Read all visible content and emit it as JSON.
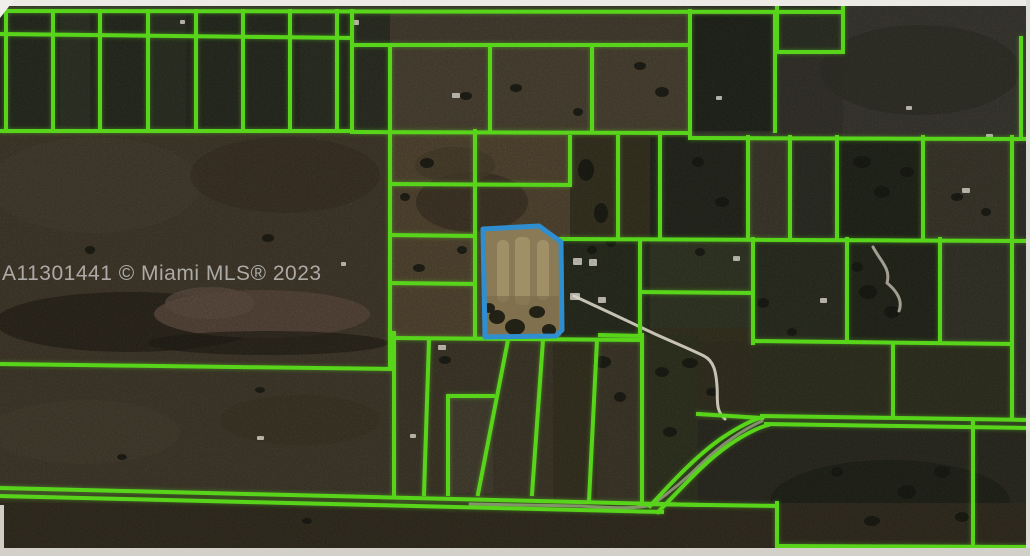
{
  "map": {
    "watermark": "A11301441 © Miami MLS® 2023",
    "colors": {
      "parcel_line": "#58d51b",
      "subject_parcel_line": "#2f8ecf",
      "subject_parcel_fill": "#8a7a55",
      "road": "#d8d3c5",
      "watermark_text": "#b6b5b1",
      "terrain_base": "#37321f"
    },
    "viewport": {
      "width": 1030,
      "height": 556
    },
    "terrain": [
      {
        "t": "rect",
        "x": 0,
        "y": 0,
        "width": 1030,
        "height": 556,
        "fill": "#37321f"
      },
      {
        "t": "rect",
        "x": 0,
        "y": 0,
        "width": 1030,
        "height": 11,
        "fill": "#3b372c"
      },
      {
        "t": "ellipse",
        "cx": 150,
        "cy": 70,
        "rx": 80,
        "ry": 40,
        "fill": "#20231a",
        "opacity": 0.5
      },
      {
        "t": "ellipse",
        "cx": 520,
        "cy": 55,
        "rx": 120,
        "ry": 40,
        "fill": "#403a2c",
        "opacity": 0.5
      },
      {
        "t": "rect",
        "x": 0,
        "y": 10,
        "width": 352,
        "height": 121,
        "fill": "#262a1e"
      },
      {
        "t": "rect",
        "x": 60,
        "y": 14,
        "width": 30,
        "height": 115,
        "fill": "#353b2b",
        "opacity": 0.5
      },
      {
        "t": "rect",
        "x": 152,
        "y": 14,
        "width": 34,
        "height": 115,
        "fill": "#323828",
        "opacity": 0.45
      },
      {
        "t": "rect",
        "x": 300,
        "y": 14,
        "width": 36,
        "height": 115,
        "fill": "#2d3224",
        "opacity": 0.5
      },
      {
        "t": "rect",
        "x": 352,
        "y": 10,
        "width": 38,
        "height": 121,
        "fill": "#2b2e22"
      },
      {
        "t": "rect",
        "x": 390,
        "y": 10,
        "width": 300,
        "height": 35,
        "fill": "#463e30"
      },
      {
        "t": "rect",
        "x": 390,
        "y": 45,
        "width": 300,
        "height": 86,
        "fill": "#4d4433"
      },
      {
        "t": "rect",
        "x": 690,
        "y": 0,
        "width": 340,
        "height": 138,
        "fill": "#34322a"
      },
      {
        "t": "rect",
        "x": 692,
        "y": 15,
        "width": 83,
        "height": 116,
        "fill": "#20241a"
      },
      {
        "t": "rect",
        "x": 777,
        "y": 0,
        "width": 66,
        "height": 52,
        "fill": "#2c3024"
      },
      {
        "t": "rect",
        "x": 843,
        "y": 0,
        "width": 187,
        "height": 138,
        "fill": "#3a3830"
      },
      {
        "t": "ellipse",
        "cx": 920,
        "cy": 70,
        "rx": 100,
        "ry": 45,
        "fill": "#302e26",
        "opacity": 0.8
      },
      {
        "t": "rect",
        "x": 0,
        "y": 131,
        "width": 390,
        "height": 234,
        "fill": "#42392a"
      },
      {
        "t": "ellipse",
        "cx": 95,
        "cy": 185,
        "rx": 105,
        "ry": 48,
        "fill": "#4b4132",
        "opacity": 0.55
      },
      {
        "t": "ellipse",
        "cx": 285,
        "cy": 175,
        "rx": 95,
        "ry": 38,
        "fill": "#392f22",
        "opacity": 0.6
      },
      {
        "t": "ellipse",
        "cx": 130,
        "cy": 322,
        "rx": 135,
        "ry": 30,
        "fill": "#241f15",
        "opacity": 0.75
      },
      {
        "t": "ellipse",
        "cx": 262,
        "cy": 314,
        "rx": 108,
        "ry": 24,
        "fill": "#5a483a"
      },
      {
        "t": "ellipse",
        "cx": 210,
        "cy": 303,
        "rx": 45,
        "ry": 16,
        "fill": "#635044",
        "opacity": 0.8
      },
      {
        "t": "ellipse",
        "cx": 268,
        "cy": 343,
        "rx": 120,
        "ry": 12,
        "fill": "#1d1a12",
        "opacity": 0.65
      },
      {
        "t": "rect",
        "x": 390,
        "y": 131,
        "width": 180,
        "height": 209,
        "fill": "#564831"
      },
      {
        "t": "ellipse",
        "cx": 472,
        "cy": 202,
        "rx": 56,
        "ry": 30,
        "fill": "#3d3325",
        "opacity": 0.85
      },
      {
        "t": "ellipse",
        "cx": 455,
        "cy": 165,
        "rx": 40,
        "ry": 18,
        "fill": "#4a3e2c",
        "opacity": 0.8
      },
      {
        "t": "rect",
        "x": 561,
        "y": 238,
        "width": 89,
        "height": 100,
        "fill": "#272b1c"
      },
      {
        "t": "rect",
        "x": 650,
        "y": 137,
        "width": 98,
        "height": 102,
        "fill": "#23261c"
      },
      {
        "t": "rect",
        "x": 748,
        "y": 137,
        "width": 42,
        "height": 102,
        "fill": "#3e392d"
      },
      {
        "t": "rect",
        "x": 790,
        "y": 137,
        "width": 47,
        "height": 102,
        "fill": "#2b2d23"
      },
      {
        "t": "rect",
        "x": 837,
        "y": 137,
        "width": 86,
        "height": 102,
        "fill": "#202418"
      },
      {
        "t": "rect",
        "x": 923,
        "y": 137,
        "width": 89,
        "height": 102,
        "fill": "#3b372b"
      },
      {
        "t": "rect",
        "x": 1012,
        "y": 137,
        "width": 18,
        "height": 281,
        "fill": "#31302a"
      },
      {
        "t": "rect",
        "x": 650,
        "y": 240,
        "width": 103,
        "height": 88,
        "fill": "#323723"
      },
      {
        "t": "rect",
        "x": 753,
        "y": 240,
        "width": 94,
        "height": 101,
        "fill": "#2a2d1f"
      },
      {
        "t": "rect",
        "x": 847,
        "y": 240,
        "width": 93,
        "height": 101,
        "fill": "#23261a"
      },
      {
        "t": "rect",
        "x": 940,
        "y": 240,
        "width": 72,
        "height": 101,
        "fill": "#343429"
      },
      {
        "t": "rect",
        "x": 753,
        "y": 341,
        "width": 259,
        "height": 77,
        "fill": "#30311f"
      },
      {
        "t": "rect",
        "x": 698,
        "y": 341,
        "width": 55,
        "height": 79,
        "fill": "#33301f"
      },
      {
        "t": "rect",
        "x": 0,
        "y": 368,
        "width": 394,
        "height": 127,
        "fill": "#413a2b"
      },
      {
        "t": "ellipse",
        "cx": 85,
        "cy": 432,
        "rx": 95,
        "ry": 32,
        "fill": "#4a4232",
        "opacity": 0.5
      },
      {
        "t": "ellipse",
        "cx": 300,
        "cy": 420,
        "rx": 80,
        "ry": 25,
        "fill": "#39321f",
        "opacity": 0.5
      },
      {
        "t": "rect",
        "x": 394,
        "y": 337,
        "width": 248,
        "height": 166,
        "fill": "#3e3828"
      },
      {
        "t": "rect",
        "x": 448,
        "y": 396,
        "width": 45,
        "height": 97,
        "fill": "#464030"
      },
      {
        "t": "rect",
        "x": 553,
        "y": 340,
        "width": 44,
        "height": 158,
        "fill": "#36311f"
      },
      {
        "t": "rect",
        "x": 642,
        "y": 335,
        "width": 56,
        "height": 168,
        "fill": "#2f331e"
      },
      {
        "t": "rect",
        "x": 698,
        "y": 420,
        "width": 332,
        "height": 126,
        "fill": "#2b2a20"
      },
      {
        "t": "ellipse",
        "cx": 890,
        "cy": 502,
        "rx": 120,
        "ry": 42,
        "fill": "#1d2015",
        "opacity": 0.8
      },
      {
        "t": "rect",
        "x": 0,
        "y": 503,
        "width": 1030,
        "height": 45,
        "fill": "#322c1e"
      }
    ],
    "vegetation_spots": [
      [
        427,
        163,
        7,
        5
      ],
      [
        405,
        197,
        5,
        4
      ],
      [
        419,
        268,
        6,
        4
      ],
      [
        462,
        250,
        5,
        4
      ],
      [
        466,
        96,
        6,
        4
      ],
      [
        516,
        88,
        6,
        4
      ],
      [
        578,
        112,
        5,
        4
      ],
      [
        586,
        170,
        8,
        11
      ],
      [
        601,
        213,
        7,
        10
      ],
      [
        611,
        242,
        5,
        5
      ],
      [
        592,
        250,
        5,
        4
      ],
      [
        640,
        66,
        6,
        4
      ],
      [
        662,
        92,
        7,
        5
      ],
      [
        698,
        162,
        6,
        5
      ],
      [
        722,
        202,
        7,
        5
      ],
      [
        700,
        252,
        5,
        4
      ],
      [
        763,
        303,
        6,
        5
      ],
      [
        792,
        332,
        5,
        4
      ],
      [
        862,
        162,
        9,
        6
      ],
      [
        882,
        192,
        8,
        6
      ],
      [
        907,
        172,
        7,
        5
      ],
      [
        957,
        197,
        6,
        4
      ],
      [
        986,
        212,
        5,
        4
      ],
      [
        868,
        292,
        9,
        7
      ],
      [
        892,
        312,
        8,
        6
      ],
      [
        857,
        267,
        6,
        5
      ],
      [
        602,
        362,
        9,
        6
      ],
      [
        620,
        397,
        6,
        5
      ],
      [
        662,
        372,
        7,
        5
      ],
      [
        690,
        363,
        8,
        5
      ],
      [
        712,
        392,
        6,
        4
      ],
      [
        670,
        432,
        7,
        5
      ],
      [
        260,
        390,
        5,
        3
      ],
      [
        122,
        457,
        5,
        3
      ],
      [
        307,
        521,
        5,
        3
      ],
      [
        942,
        472,
        8,
        6
      ],
      [
        907,
        492,
        9,
        7
      ],
      [
        962,
        517,
        7,
        5
      ],
      [
        837,
        472,
        6,
        5
      ],
      [
        872,
        521,
        8,
        5
      ],
      [
        445,
        360,
        6,
        4
      ],
      [
        268,
        238,
        6,
        4
      ],
      [
        90,
        250,
        5,
        4
      ]
    ],
    "structures": [
      [
        573,
        258,
        9,
        7
      ],
      [
        589,
        259,
        8,
        7
      ],
      [
        570,
        293,
        10,
        7
      ],
      [
        598,
        297,
        8,
        6
      ],
      [
        733,
        256,
        7,
        5
      ],
      [
        820,
        298,
        7,
        5
      ],
      [
        962,
        188,
        8,
        5
      ],
      [
        986,
        134,
        7,
        5
      ],
      [
        352,
        20,
        7,
        5
      ],
      [
        452,
        93,
        8,
        5
      ],
      [
        257,
        436,
        7,
        4
      ],
      [
        438,
        345,
        8,
        5
      ],
      [
        410,
        434,
        6,
        4
      ],
      [
        716,
        96,
        6,
        4
      ],
      [
        906,
        106,
        6,
        4
      ],
      [
        341,
        262,
        5,
        4
      ],
      [
        180,
        20,
        5,
        4
      ]
    ],
    "roads": [
      {
        "d": "M574,296 C600,308 630,322 655,334 C675,343 692,350 704,356 C714,361 716,372 717,386 C718,400 715,410 725,419",
        "opacity": 0.9
      },
      {
        "d": "M762,421 C744,429 722,444 702,463 C684,481 666,495 652,505 C640,509 610,508 580,506 L470,504",
        "opacity": 0.55
      },
      {
        "d": "M873,247 C881,262 891,269 887,283 C897,291 903,301 899,311",
        "opacity": 0.7
      }
    ],
    "parcel_lines": [
      [
        0,
        11,
        843,
        12
      ],
      [
        0,
        34,
        352,
        38
      ],
      [
        352,
        45,
        690,
        45
      ],
      [
        0,
        131,
        352,
        131
      ],
      [
        352,
        132,
        690,
        133
      ],
      [
        690,
        138,
        1030,
        139
      ],
      [
        6,
        11,
        6,
        131
      ],
      [
        53,
        11,
        53,
        131
      ],
      [
        100,
        11,
        100,
        131
      ],
      [
        148,
        11,
        148,
        131
      ],
      [
        196,
        11,
        196,
        131
      ],
      [
        243,
        11,
        243,
        131
      ],
      [
        290,
        11,
        290,
        131
      ],
      [
        337,
        11,
        337,
        131
      ],
      [
        352,
        11,
        352,
        131
      ],
      [
        390,
        45,
        390,
        131
      ],
      [
        490,
        45,
        490,
        131
      ],
      [
        592,
        45,
        592,
        131
      ],
      [
        690,
        11,
        690,
        138
      ],
      [
        775,
        12,
        775,
        131
      ],
      [
        777,
        3,
        777,
        52
      ],
      [
        843,
        3,
        843,
        52
      ],
      [
        777,
        52,
        843,
        52
      ],
      [
        1021,
        38,
        1021,
        138
      ],
      [
        390,
        131,
        390,
        368
      ],
      [
        475,
        131,
        475,
        337
      ],
      [
        390,
        184,
        570,
        185
      ],
      [
        390,
        235,
        475,
        236
      ],
      [
        390,
        283,
        475,
        284
      ],
      [
        570,
        137,
        570,
        185
      ],
      [
        618,
        137,
        618,
        239
      ],
      [
        660,
        137,
        660,
        239
      ],
      [
        561,
        239,
        1030,
        241
      ],
      [
        748,
        137,
        748,
        239
      ],
      [
        790,
        137,
        790,
        239
      ],
      [
        837,
        137,
        837,
        239
      ],
      [
        923,
        137,
        923,
        239
      ],
      [
        1012,
        137,
        1012,
        418
      ],
      [
        640,
        241,
        640,
        335
      ],
      [
        640,
        292,
        753,
        293
      ],
      [
        753,
        239,
        753,
        343
      ],
      [
        847,
        239,
        847,
        341
      ],
      [
        940,
        239,
        940,
        341
      ],
      [
        753,
        341,
        1012,
        344
      ],
      [
        600,
        335,
        642,
        336
      ],
      [
        0,
        364,
        394,
        369
      ],
      [
        394,
        333,
        394,
        496
      ],
      [
        394,
        338,
        642,
        340
      ],
      [
        429,
        340,
        424,
        494
      ],
      [
        508,
        340,
        478,
        494
      ],
      [
        448,
        396,
        493,
        396
      ],
      [
        448,
        396,
        448,
        494
      ],
      [
        543,
        340,
        532,
        494
      ],
      [
        597,
        340,
        589,
        501
      ],
      [
        642,
        335,
        642,
        503
      ],
      [
        0,
        488,
        700,
        505
      ],
      [
        0,
        496,
        662,
        512
      ],
      [
        698,
        414,
        762,
        418
      ],
      [
        762,
        416,
        1030,
        420
      ],
      [
        766,
        424,
        1030,
        428
      ],
      [
        893,
        346,
        893,
        417
      ],
      [
        973,
        421,
        973,
        546
      ],
      [
        777,
        503,
        777,
        546
      ],
      [
        640,
        504,
        777,
        506
      ],
      [
        777,
        546,
        1030,
        547
      ]
    ],
    "parcel_curves": [
      "M650,506 C673,481 696,456 722,438 C740,426 752,420 763,417",
      "M658,512 C681,489 703,463 729,445 C745,434 757,428 768,425"
    ],
    "subject_parcel": {
      "path": "M483,229 L539,226 L561,242 L562,330 L556,336 L485,337 Z",
      "streaks": [
        [
          497,
          240,
          12,
          62
        ],
        [
          515,
          237,
          15,
          68
        ],
        [
          537,
          240,
          12,
          60
        ]
      ],
      "shade": [
        486,
        296,
        73,
        38
      ],
      "spots": [
        [
          497,
          317,
          8,
          7
        ],
        [
          515,
          327,
          10,
          8
        ],
        [
          537,
          312,
          8,
          6
        ],
        [
          549,
          330,
          7,
          6
        ],
        [
          489,
          308,
          6,
          5
        ]
      ]
    },
    "frame": [
      {
        "t": "rect",
        "x": 0,
        "y": 0,
        "width": 1030,
        "height": 6,
        "fill": "#eceae5"
      },
      {
        "t": "rect",
        "x": 1026,
        "y": 0,
        "width": 4,
        "height": 556,
        "fill": "#dedcd6"
      },
      {
        "t": "rect",
        "x": 0,
        "y": 548,
        "width": 1030,
        "height": 8,
        "fill": "#d2d0c9"
      },
      {
        "t": "rect",
        "x": 0,
        "y": 505,
        "width": 4,
        "height": 43,
        "fill": "#cfcdc6"
      },
      {
        "t": "path",
        "d": "M0,0 L14,0 L0,18 Z",
        "fill": "#f0efe9"
      }
    ]
  }
}
